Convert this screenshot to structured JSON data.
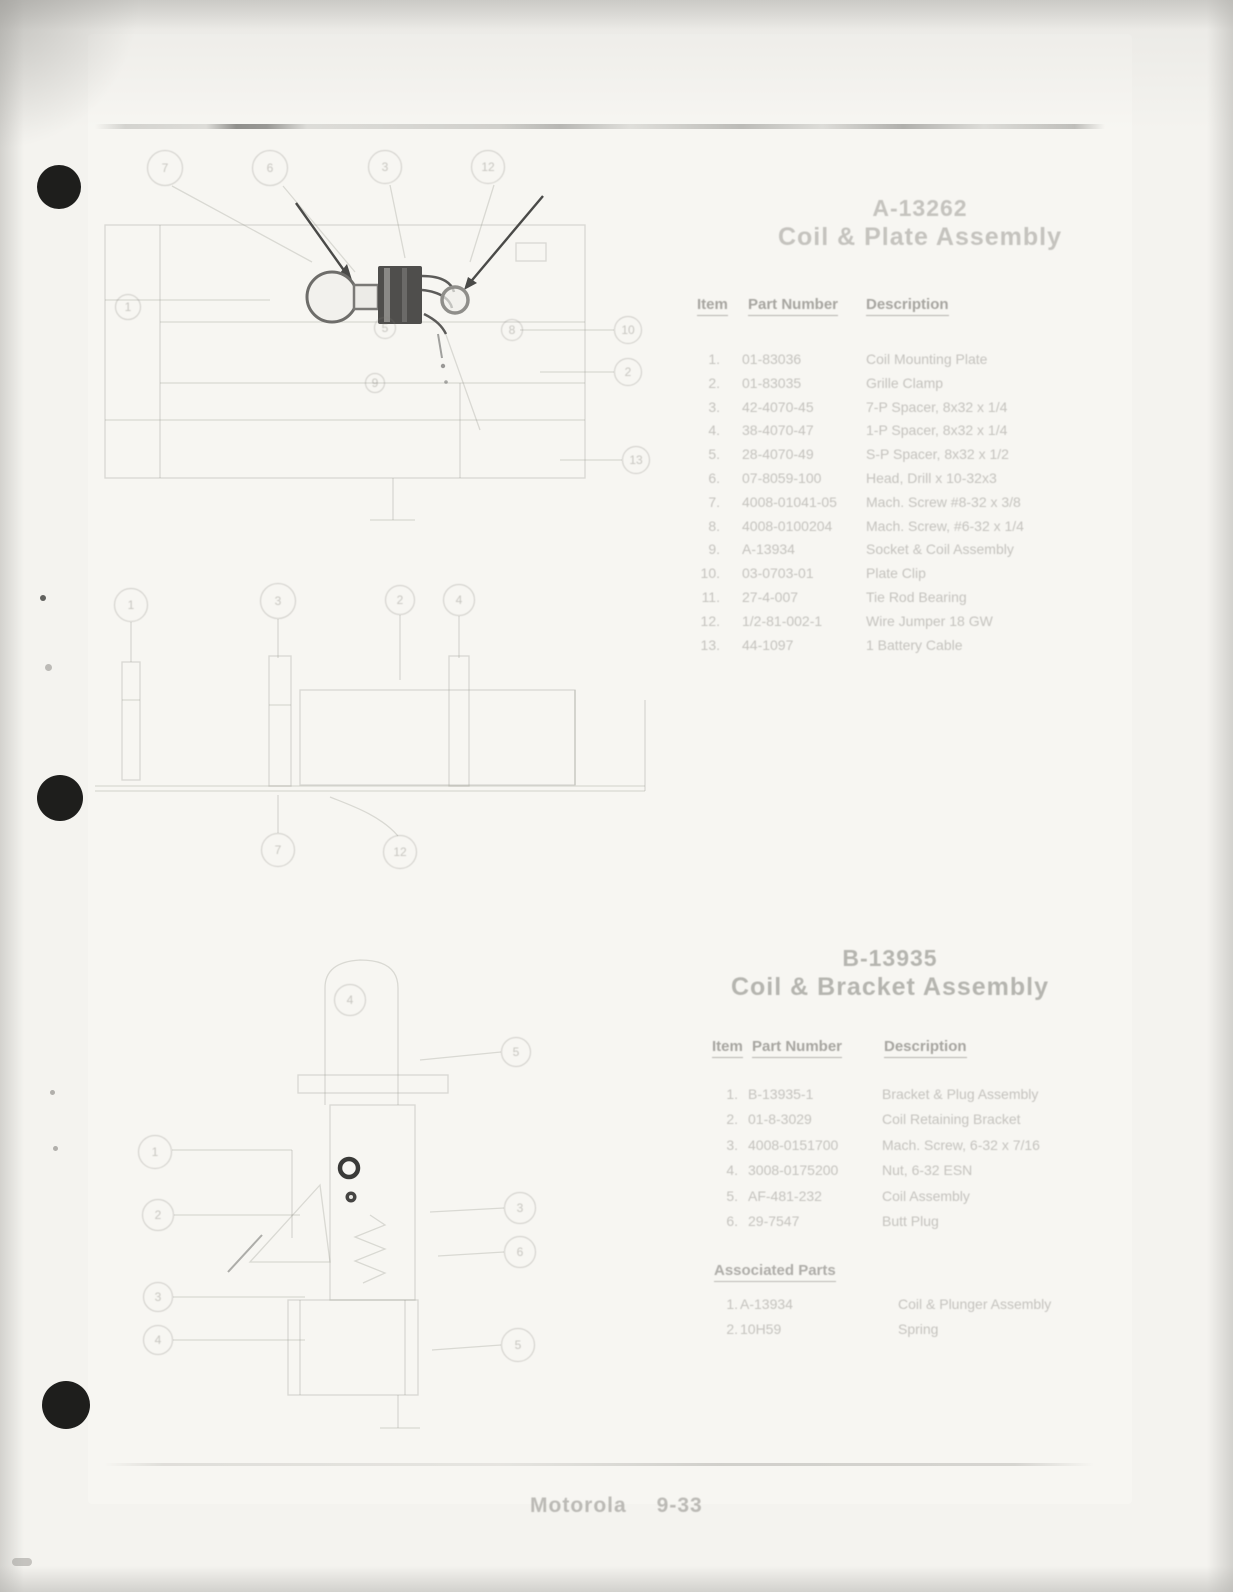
{
  "footer": {
    "brand": "Motorola",
    "page_no": "9-33"
  },
  "section_a": {
    "part_code": "A-13262",
    "title": "Coil & Plate Assembly",
    "table": {
      "headers": {
        "item": "Item",
        "part": "Part Number",
        "desc": "Description"
      },
      "rows": [
        {
          "item": "1.",
          "part": "01-83036",
          "desc": "Coil Mounting Plate"
        },
        {
          "item": "2.",
          "part": "01-83035",
          "desc": "Grille Clamp"
        },
        {
          "item": "3.",
          "part": "42-4070-45",
          "desc": "7-P Spacer, 8x32 x 1/4"
        },
        {
          "item": "4.",
          "part": "38-4070-47",
          "desc": "1-P Spacer, 8x32 x 1/4"
        },
        {
          "item": "5.",
          "part": "28-4070-49",
          "desc": "S-P Spacer, 8x32 x 1/2"
        },
        {
          "item": "6.",
          "part": "07-8059-100",
          "desc": "Head, Drill x 10-32x3"
        },
        {
          "item": "7.",
          "part": "4008-01041-05",
          "desc": "Mach. Screw #8-32 x 3/8"
        },
        {
          "item": "8.",
          "part": "4008-0100204",
          "desc": "Mach. Screw, #6-32 x 1/4"
        },
        {
          "item": "9.",
          "part": "A-13934",
          "desc": "Socket & Coil Assembly"
        },
        {
          "item": "10.",
          "part": "03-0703-01",
          "desc": "Plate Clip"
        },
        {
          "item": "11.",
          "part": "27-4-007",
          "desc": "Tie Rod Bearing"
        },
        {
          "item": "12.",
          "part": "1/2-81-002-1",
          "desc": "Wire Jumper 18 GW"
        },
        {
          "item": "13.",
          "part": "44-1097",
          "desc": "1 Battery Cable"
        }
      ]
    }
  },
  "section_b": {
    "part_code": "B-13935",
    "title": "Coil & Bracket Assembly",
    "table": {
      "headers": {
        "item": "Item",
        "part": "Part Number",
        "desc": "Description"
      },
      "rows": [
        {
          "item": "1.",
          "part": "B-13935-1",
          "desc": "Bracket & Plug Assembly"
        },
        {
          "item": "2.",
          "part": "01-8-3029",
          "desc": "Coil Retaining Bracket"
        },
        {
          "item": "3.",
          "part": "4008-0151700",
          "desc": "Mach. Screw, 6-32 x 7/16"
        },
        {
          "item": "4.",
          "part": "3008-0175200",
          "desc": "Nut, 6-32 ESN"
        },
        {
          "item": "5.",
          "part": "AF-481-232",
          "desc": "Coil Assembly"
        },
        {
          "item": "6.",
          "part": "29-7547",
          "desc": "Butt Plug"
        }
      ]
    },
    "associated": {
      "heading": "Associated Parts",
      "rows": [
        {
          "item": "1.",
          "part": "A-13934",
          "desc": "Coil & Plunger Assembly"
        },
        {
          "item": "2.",
          "part": "10H59",
          "desc": "Spring"
        }
      ]
    }
  },
  "diagrams": {
    "plate": {
      "callouts": [
        {
          "x": 165,
          "y": 168,
          "r": 18,
          "label": "7"
        },
        {
          "x": 270,
          "y": 168,
          "r": 18,
          "label": "6"
        },
        {
          "x": 385,
          "y": 167,
          "r": 17,
          "label": "3"
        },
        {
          "x": 488,
          "y": 167,
          "r": 17,
          "label": "12"
        },
        {
          "x": 128,
          "y": 307,
          "r": 13,
          "label": "1"
        },
        {
          "x": 385,
          "y": 328,
          "r": 11,
          "label": "5"
        },
        {
          "x": 512,
          "y": 330,
          "r": 11,
          "label": "8"
        },
        {
          "x": 375,
          "y": 383,
          "r": 10,
          "label": "9"
        },
        {
          "x": 628,
          "y": 330,
          "r": 14,
          "label": "10"
        },
        {
          "x": 628,
          "y": 372,
          "r": 14,
          "label": "2"
        },
        {
          "x": 636,
          "y": 460,
          "r": 14,
          "label": "13"
        }
      ]
    },
    "hardware": {
      "callouts": [
        {
          "x": 131,
          "y": 605,
          "r": 17,
          "label": "1"
        },
        {
          "x": 278,
          "y": 601,
          "r": 18,
          "label": "3"
        },
        {
          "x": 400,
          "y": 600,
          "r": 15,
          "label": "2"
        },
        {
          "x": 459,
          "y": 600,
          "r": 16,
          "label": "4"
        },
        {
          "x": 278,
          "y": 850,
          "r": 17,
          "label": "7"
        },
        {
          "x": 400,
          "y": 852,
          "r": 17,
          "label": "12"
        }
      ]
    },
    "bracket": {
      "callouts": [
        {
          "x": 350,
          "y": 1000,
          "r": 16,
          "label": "4"
        },
        {
          "x": 516,
          "y": 1052,
          "r": 15,
          "label": "5"
        },
        {
          "x": 155,
          "y": 1152,
          "r": 17,
          "label": "1"
        },
        {
          "x": 158,
          "y": 1215,
          "r": 16,
          "label": "2"
        },
        {
          "x": 520,
          "y": 1208,
          "r": 16,
          "label": "3"
        },
        {
          "x": 520,
          "y": 1252,
          "r": 16,
          "label": "6"
        },
        {
          "x": 158,
          "y": 1297,
          "r": 15,
          "label": "3"
        },
        {
          "x": 158,
          "y": 1340,
          "r": 15,
          "label": "4"
        },
        {
          "x": 518,
          "y": 1345,
          "r": 17,
          "label": "5"
        }
      ]
    }
  }
}
